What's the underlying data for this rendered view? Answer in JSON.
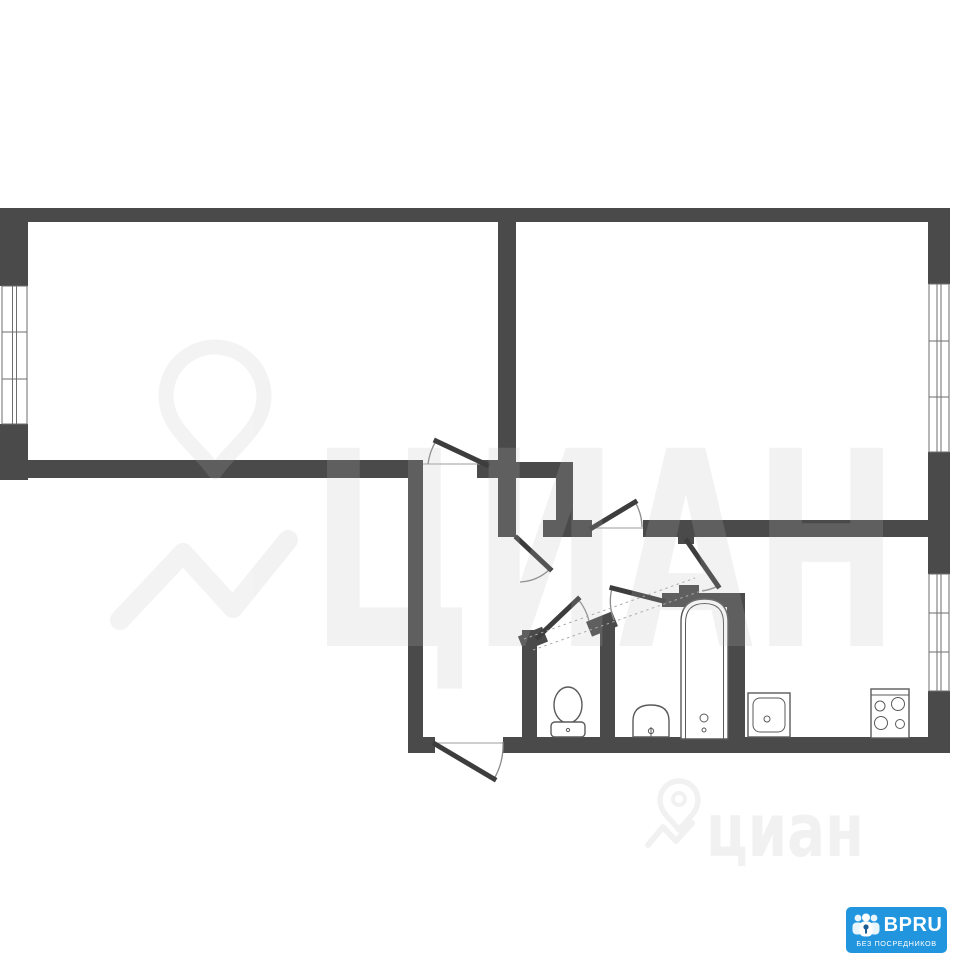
{
  "page": {
    "background": "#ffffff",
    "width": 960,
    "height": 960
  },
  "plan": {
    "kind": "apartment-floor-plan",
    "wall_color": "#4a4a4a",
    "door_color": "#3d3d3d",
    "fixture_line_color": "#5a5a5a",
    "fixtures": [
      "toilet",
      "wash-basin",
      "bathtub",
      "kitchen-sink",
      "stove-4-burners"
    ],
    "windows_count": 3,
    "doors_count": 7
  },
  "watermark": {
    "color": "#bdbdbd",
    "opacity": 0.18,
    "center_text": "ЦИАН",
    "bottom_text": "циан"
  },
  "badge": {
    "bg": "#2196df",
    "text_color": "#ffffff",
    "brand": "BPRU",
    "tagline": "БЕЗ ПОСРЕДНИКОВ"
  }
}
